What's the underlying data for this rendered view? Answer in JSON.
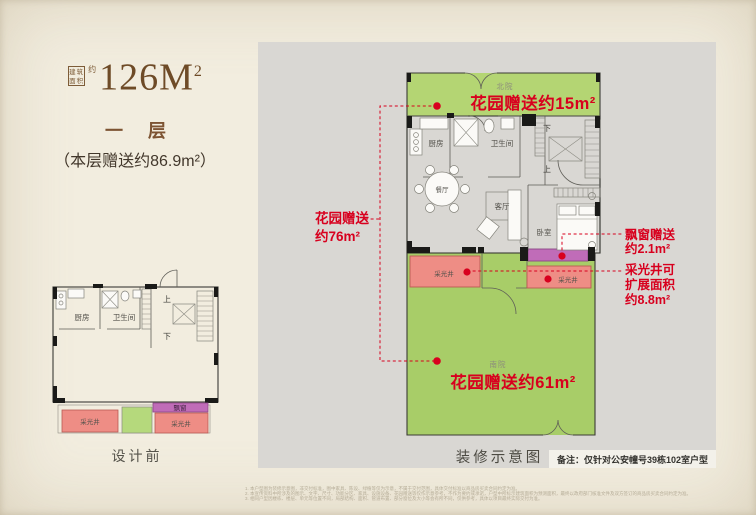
{
  "colors": {
    "accent_red": "#d8001e",
    "garden_green": "#adcf6c",
    "light_well_pink": "#ee8d85",
    "bay_window_purple": "#c06cb8",
    "title_brown": "#6e4b27",
    "panel_gray": "#d9d7d3",
    "page_cream": "#f2eddf"
  },
  "left_panel": {
    "area_box_label": "建筑面积",
    "area_approx": "约",
    "area_value": "126M",
    "area_sup": "2",
    "floor_label": "一 层",
    "floor_bonus": "（本层赠送约86.9m²）",
    "before_caption": "设计前"
  },
  "rooms": {
    "kitchen": "厨房",
    "bathroom": "卫生间",
    "dining": "餐厅",
    "living": "客厅",
    "bedroom": "卧室",
    "light_well": "采光井",
    "bay_window": "飘窗",
    "up": "上",
    "down": "下",
    "north_yard": "北院",
    "south_yard": "南院"
  },
  "annotations": {
    "garden_north": "花园赠送约15m²",
    "garden_west_line1": "花园赠送",
    "garden_west_line2": "约76m²",
    "garden_south": "花园赠送约61m²",
    "bay_line1": "飘窗赠送",
    "bay_line2": "约2.1m²",
    "lightwell_line1": "采光井可",
    "lightwell_line2": "扩展面积",
    "lightwell_line3": "约8.8m²"
  },
  "captions": {
    "main_plan": "装修示意图",
    "note": "备注：仅针对公安幢号39栋102室户型"
  },
  "disclaimer": {
    "line1": "1. 本户型图为装修示意图，非交付标准，图中家具、陈设、绿植等仅为示意，不属于交付范围，具体交付标准以商品房买卖合同约定为准。",
    "line2": "2. 本宣传资料中所涉及的图示、文字、尺寸、功能分区、家具、设施设备、花园赠送等仅作示意参考，不作为要约或承诺，户型中所标示建筑面积为预测面积，最终以政府部门核准文件及双方签订的商品房买卖合同约定为准。",
    "line3": "3. 相同户型因楼栋、楼层、单元等位置不同，局部结构、面积、管道布置、部分窗位及大小等会有所不同，仅供参考，具体以项目最终实际交付为准。"
  }
}
